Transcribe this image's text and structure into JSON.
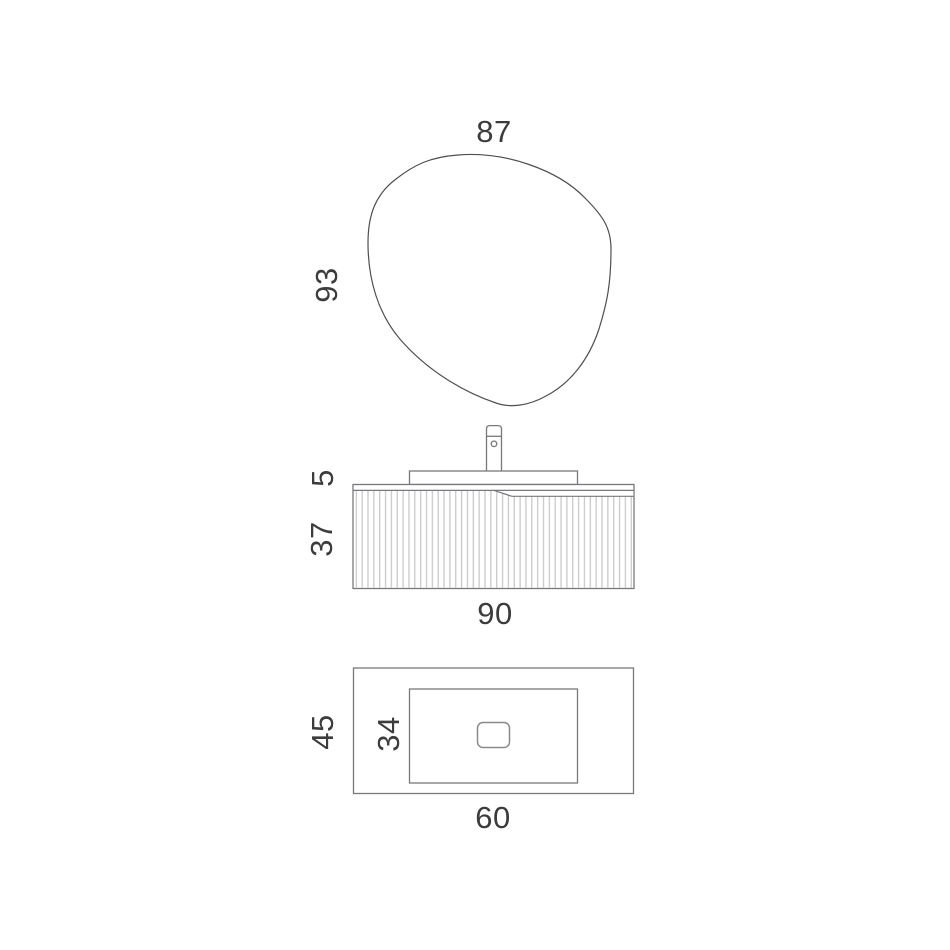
{
  "labels": {
    "mirror_width": "87",
    "mirror_height": "93",
    "counter_height": "5",
    "cabinet_height": "37",
    "cabinet_width": "90",
    "counter_depth": "45",
    "cutout_depth": "34",
    "counter_width": "60"
  },
  "colors": {
    "background": "#ffffff",
    "outline": "#77797c",
    "mirror_outline": "#4f4f4f",
    "flute_line": "#c5c5c5",
    "text": "#3c3c3c"
  }
}
